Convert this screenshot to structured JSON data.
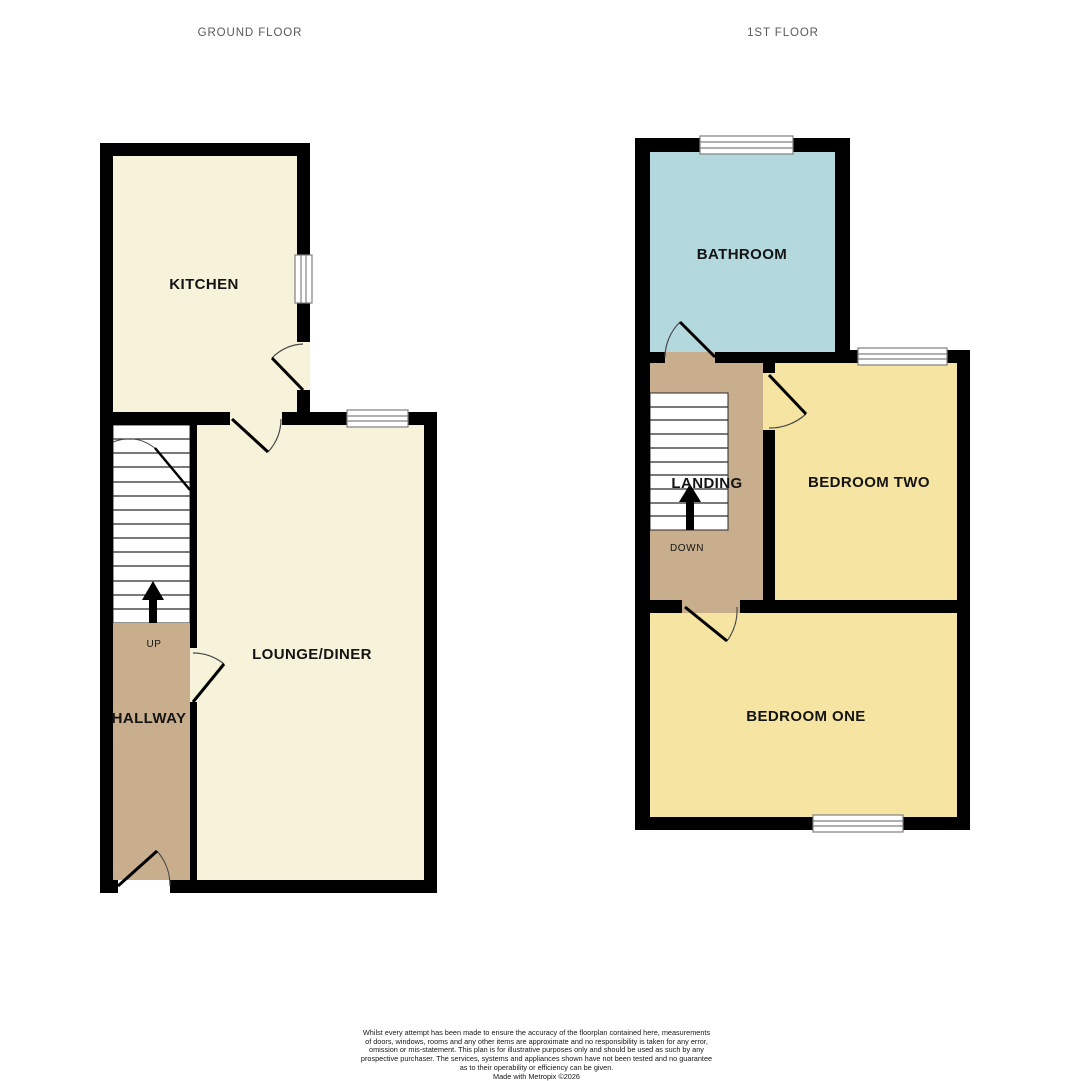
{
  "titles": {
    "ground": "GROUND FLOOR",
    "first": "1ST FLOOR"
  },
  "ground_floor": {
    "kitchen_label": "KITCHEN",
    "lounge_label": "LOUNGE/DINER",
    "hallway_label": "HALLWAY",
    "stairs_direction": "UP"
  },
  "first_floor": {
    "bathroom_label": "BATHROOM",
    "bedroom_two_label": "BEDROOM TWO",
    "bedroom_one_label": "BEDROOM ONE",
    "landing_label": "LANDING",
    "stairs_direction": "DOWN"
  },
  "disclaimer": {
    "lines": [
      "Whilst every attempt has been made to ensure the accuracy of the floorplan contained here, measurements",
      "of doors, windows, rooms and any other items are approximate and no responsibility is taken for any error,",
      "omission or mis-statement. This plan is for illustrative purposes only and should be used as such by any",
      "prospective purchaser. The services, systems and appliances shown have not been tested and no guarantee",
      "as to their operability or efficiency can be given.",
      "Made with Metropix ©2026"
    ]
  },
  "colors": {
    "wall": "#000000",
    "cream": "#f7f2da",
    "tan": "#c8ae8d",
    "blue": "#b3d8de",
    "yellow": "#f6e4a3",
    "window_frame": "#808080",
    "door_arc": "#4a4a4a",
    "stair_line": "#2b2b2b",
    "label_text": "#141414",
    "title_text": "#58595b"
  }
}
